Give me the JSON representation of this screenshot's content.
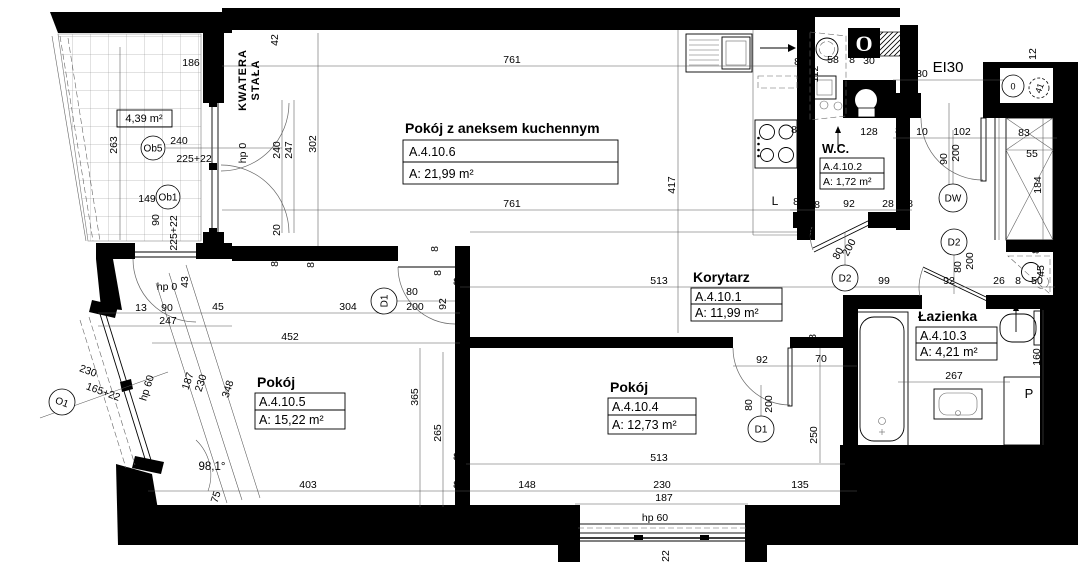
{
  "plan_title": "Apartment floor plan A.4.10",
  "rooms": [
    {
      "name": "Pokój z aneksem kuchennym",
      "id": "A.4.10.6",
      "area": "A: 21,99 m²"
    },
    {
      "name": "W.C.",
      "id": "A.4.10.2",
      "area": "A: 1,72 m²"
    },
    {
      "name": "Korytarz",
      "id": "A.4.10.1",
      "area": "A: 11,99 m²"
    },
    {
      "name": "Pokój",
      "id": "A.4.10.5",
      "area": "A: 15,22 m²"
    },
    {
      "name": "Pokój",
      "id": "A.4.10.4",
      "area": "A: 12,73 m²"
    },
    {
      "name": "Łazienka",
      "id": "A.4.10.3",
      "area": "A: 4,21 m²"
    }
  ],
  "balcony": {
    "area": "4,39 m²"
  },
  "annotations": {
    "kwatera_line1": "KWATERA",
    "kwatera_line2": "STAŁA",
    "entrance_rating": "EI30",
    "vent": "O"
  },
  "markers": [
    {
      "label": "Ob5",
      "x": 153,
      "y": 148,
      "rad": 12
    },
    {
      "label": "Ob1",
      "x": 168,
      "y": 197,
      "rad": 12
    },
    {
      "label": "O1",
      "x": 62,
      "y": 402,
      "rad": 13,
      "r": 20
    },
    {
      "label": "D1",
      "x": 384,
      "y": 301,
      "rad": 13,
      "r": -90
    },
    {
      "label": "D1",
      "x": 761,
      "y": 429,
      "rad": 13
    },
    {
      "label": "D2",
      "x": 845,
      "y": 278,
      "rad": 13
    },
    {
      "label": "D2",
      "x": 954,
      "y": 242,
      "rad": 13
    },
    {
      "label": "DW",
      "x": 953,
      "y": 198,
      "rad": 14
    },
    {
      "label": "0",
      "x": 1013,
      "y": 86,
      "rad": 11,
      "fs": 9
    },
    {
      "label": "41",
      "x": 1039,
      "y": 88,
      "rad": 10,
      "r": -70,
      "dash": true,
      "fs": 9
    }
  ],
  "dimensions": [
    {
      "t": "186",
      "x": 191,
      "y": 66
    },
    {
      "t": "46",
      "x": 216,
      "y": 69
    },
    {
      "t": "42",
      "x": 278,
      "y": 40,
      "r": -90
    },
    {
      "t": "263",
      "x": 117,
      "y": 145,
      "r": -90
    },
    {
      "t": "240",
      "x": 179,
      "y": 144
    },
    {
      "t": "225+22",
      "x": 194,
      "y": 162
    },
    {
      "t": "149",
      "x": 147,
      "y": 202
    },
    {
      "t": "90",
      "x": 159,
      "y": 220,
      "r": -90
    },
    {
      "t": "225+22",
      "x": 177,
      "y": 233,
      "r": -90
    },
    {
      "t": "hp 0",
      "x": 246,
      "y": 153,
      "r": -90
    },
    {
      "t": "240",
      "x": 280,
      "y": 150,
      "r": -90
    },
    {
      "t": "247",
      "x": 292,
      "y": 150,
      "r": -90
    },
    {
      "t": "302",
      "x": 316,
      "y": 144,
      "r": -90
    },
    {
      "t": "20",
      "x": 280,
      "y": 230,
      "r": -90
    },
    {
      "t": "761",
      "x": 512,
      "y": 63
    },
    {
      "t": "761",
      "x": 512,
      "y": 207
    },
    {
      "t": "417",
      "x": 675,
      "y": 185,
      "r": -90
    },
    {
      "t": "8",
      "x": 797,
      "y": 65
    },
    {
      "t": "112",
      "x": 818,
      "y": 74,
      "r": -90
    },
    {
      "t": "58",
      "x": 833,
      "y": 63
    },
    {
      "t": "8",
      "x": 852,
      "y": 63
    },
    {
      "t": "30",
      "x": 869,
      "y": 64
    },
    {
      "t": "130",
      "x": 919,
      "y": 77
    },
    {
      "t": "12",
      "x": 989,
      "y": 78
    },
    {
      "t": "12",
      "x": 1036,
      "y": 54,
      "r": -90
    },
    {
      "t": "8",
      "x": 806,
      "y": 126,
      "r": -90
    },
    {
      "t": "128",
      "x": 869,
      "y": 135
    },
    {
      "t": "8",
      "x": 898,
      "y": 134
    },
    {
      "t": "10",
      "x": 922,
      "y": 135
    },
    {
      "t": "102",
      "x": 962,
      "y": 135
    },
    {
      "t": "83",
      "x": 1024,
      "y": 136
    },
    {
      "t": "90",
      "x": 947,
      "y": 159,
      "r": -90
    },
    {
      "t": "200",
      "x": 959,
      "y": 153,
      "r": -90
    },
    {
      "t": "55",
      "x": 1032,
      "y": 157
    },
    {
      "t": "184",
      "x": 1041,
      "y": 185,
      "r": -90
    },
    {
      "t": "8",
      "x": 794,
      "y": 133
    },
    {
      "t": "L",
      "x": 775,
      "y": 205,
      "fs": 12
    },
    {
      "t": "8",
      "x": 796,
      "y": 205
    },
    {
      "t": "8",
      "x": 817,
      "y": 208
    },
    {
      "t": "92",
      "x": 849,
      "y": 207
    },
    {
      "t": "28",
      "x": 888,
      "y": 207
    },
    {
      "t": "8",
      "x": 910,
      "y": 207
    },
    {
      "t": "297",
      "x": 812,
      "y": 231,
      "r": -78
    },
    {
      "t": "80",
      "x": 841,
      "y": 255,
      "r": -62
    },
    {
      "t": "200",
      "x": 852,
      "y": 249,
      "r": -62
    },
    {
      "t": "513",
      "x": 659,
      "y": 284
    },
    {
      "t": "99",
      "x": 884,
      "y": 284
    },
    {
      "t": "92",
      "x": 949,
      "y": 284
    },
    {
      "t": "26",
      "x": 999,
      "y": 284
    },
    {
      "t": "8",
      "x": 1018,
      "y": 284
    },
    {
      "t": "50",
      "x": 1037,
      "y": 284
    },
    {
      "t": "45",
      "x": 1044,
      "y": 271,
      "r": -90
    },
    {
      "t": "80",
      "x": 961,
      "y": 267,
      "r": -90
    },
    {
      "t": "200",
      "x": 973,
      "y": 261,
      "r": -90
    },
    {
      "t": "8",
      "x": 1039,
      "y": 251,
      "r": -90
    },
    {
      "t": "92",
      "x": 762,
      "y": 363
    },
    {
      "t": "70",
      "x": 821,
      "y": 362
    },
    {
      "t": "80",
      "x": 752,
      "y": 405,
      "r": -90
    },
    {
      "t": "200",
      "x": 772,
      "y": 404,
      "r": -90
    },
    {
      "t": "250",
      "x": 817,
      "y": 435,
      "r": -90
    },
    {
      "t": "8",
      "x": 816,
      "y": 337,
      "r": -90
    },
    {
      "t": "13",
      "x": 141,
      "y": 311
    },
    {
      "t": "90",
      "x": 167,
      "y": 311
    },
    {
      "t": "45",
      "x": 218,
      "y": 310
    },
    {
      "t": "247",
      "x": 168,
      "y": 324
    },
    {
      "t": "hp 0",
      "x": 167,
      "y": 290
    },
    {
      "t": "43",
      "x": 188,
      "y": 282,
      "r": -90
    },
    {
      "t": "304",
      "x": 348,
      "y": 310
    },
    {
      "t": "452",
      "x": 290,
      "y": 340
    },
    {
      "t": "8",
      "x": 278,
      "y": 264,
      "r": -90
    },
    {
      "t": "8",
      "x": 314,
      "y": 265,
      "r": -90
    },
    {
      "t": "80",
      "x": 412,
      "y": 295
    },
    {
      "t": "200",
      "x": 415,
      "y": 310
    },
    {
      "t": "92",
      "x": 446,
      "y": 304,
      "r": -90
    },
    {
      "t": "8",
      "x": 438,
      "y": 249,
      "r": -90
    },
    {
      "t": "8",
      "x": 441,
      "y": 273,
      "r": -90
    },
    {
      "t": "8",
      "x": 456,
      "y": 285
    },
    {
      "t": "8",
      "x": 463,
      "y": 337
    },
    {
      "t": "hp 60",
      "x": 150,
      "y": 389,
      "r": -72
    },
    {
      "t": "187",
      "x": 191,
      "y": 382,
      "r": -72
    },
    {
      "t": "230",
      "x": 204,
      "y": 384,
      "r": -72
    },
    {
      "t": "348",
      "x": 231,
      "y": 390,
      "r": -72
    },
    {
      "t": "230",
      "x": 87,
      "y": 374,
      "r": 20
    },
    {
      "t": "165+22",
      "x": 102,
      "y": 395,
      "r": 20
    },
    {
      "t": "75",
      "x": 219,
      "y": 498,
      "r": -72
    },
    {
      "t": "98,1°",
      "x": 212,
      "y": 470,
      "fs": 11.5
    },
    {
      "t": "403",
      "x": 308,
      "y": 488
    },
    {
      "t": "365",
      "x": 418,
      "y": 397,
      "r": -90
    },
    {
      "t": "265",
      "x": 441,
      "y": 433,
      "r": -90
    },
    {
      "t": "8",
      "x": 456,
      "y": 460
    },
    {
      "t": "8",
      "x": 456,
      "y": 488
    },
    {
      "t": "148",
      "x": 527,
      "y": 488
    },
    {
      "t": "513",
      "x": 659,
      "y": 461
    },
    {
      "t": "230",
      "x": 662,
      "y": 488
    },
    {
      "t": "135",
      "x": 800,
      "y": 488
    },
    {
      "t": "187",
      "x": 664,
      "y": 501
    },
    {
      "t": "hp 60",
      "x": 655,
      "y": 521
    },
    {
      "t": "22",
      "x": 669,
      "y": 556,
      "r": -90
    },
    {
      "t": "267",
      "x": 954,
      "y": 379
    },
    {
      "t": "160",
      "x": 1040,
      "y": 357,
      "r": -90
    },
    {
      "t": "8",
      "x": 1042,
      "y": 306,
      "r": -90
    },
    {
      "t": "P",
      "x": 1029,
      "y": 398,
      "fs": 13
    }
  ]
}
